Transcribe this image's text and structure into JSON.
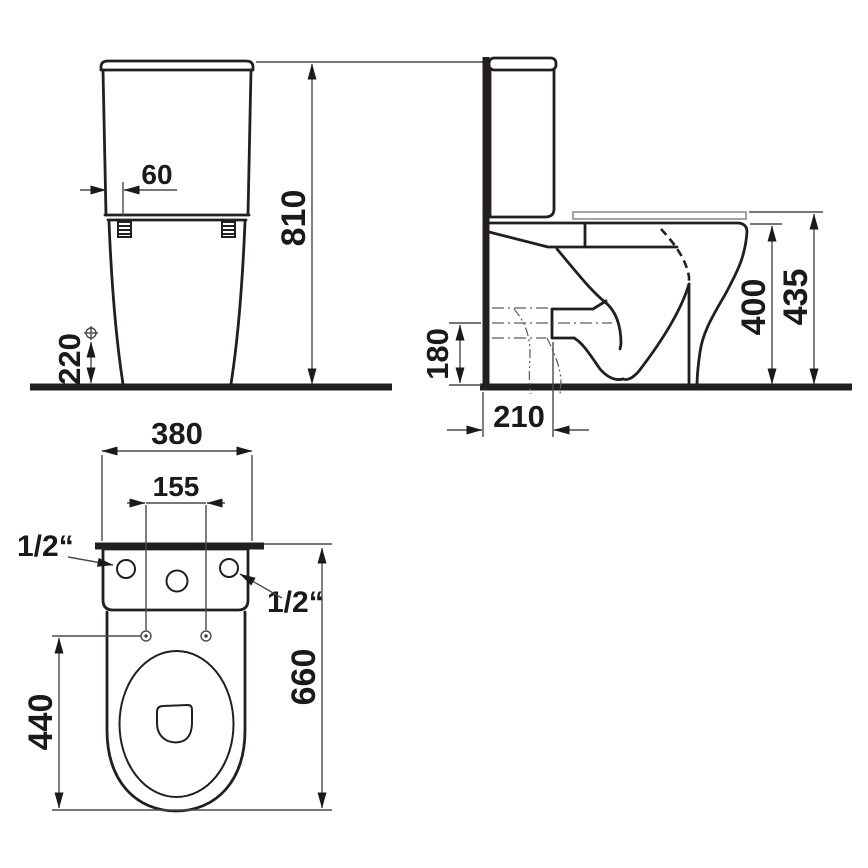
{
  "drawing": {
    "title": "toilet-technical-drawing",
    "background": "#ffffff",
    "outline_color": "#231f20",
    "dimension_line_color": "#4a4a4a",
    "seat_outline_color": "#a3a3a3",
    "views": {
      "front": "front-elevation",
      "side": "side-section",
      "plan": "top-plan"
    },
    "dimensions": {
      "front_bolt_offset": "60",
      "front_total_height": "810",
      "front_inlet_height": "220",
      "side_outlet_height": "180",
      "side_outlet_depth": "210",
      "side_rim_height": "400",
      "side_seat_height": "435",
      "plan_width": "380",
      "plan_hole_spacing": "155",
      "plan_bowl_length": "440",
      "plan_total_depth": "660",
      "plan_inlet_left": "1/2“",
      "plan_inlet_right": "1/2“"
    }
  }
}
